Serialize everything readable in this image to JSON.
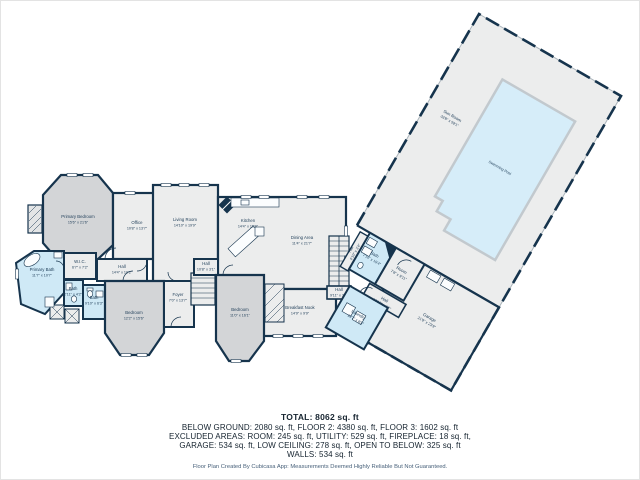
{
  "palette": {
    "wall": "#16344d",
    "room_fill": "#eceded",
    "bedroom_fill": "#d3d5d7",
    "wet_fill": "#cfe9f6",
    "pool_fill": "#d6edf9",
    "pool_border": "#c2c9ce",
    "label_color": "#1c3b56"
  },
  "rooms": [
    {
      "name": "Primary Bedroom",
      "dims": "15'6\" x 21'6\""
    },
    {
      "name": "Office",
      "dims": "10'8\" x 13'7\""
    },
    {
      "name": "Living Room",
      "dims": "14'10\" x 19'9\""
    },
    {
      "name": "Kitchen",
      "dims": "14'4\" x 15'9\""
    },
    {
      "name": "Dining Area",
      "dims": "11'4\" x 21'7\""
    },
    {
      "name": "Breakfast Nook",
      "dims": "14'9\" x 9'9\""
    },
    {
      "name": "Primary Bath",
      "dims": "11'7\" x 10'7\""
    },
    {
      "name": "W.I.C.",
      "dims": "6'7\" x 7'2\""
    },
    {
      "name": "Bath",
      "dims": "2'11\" x 4'2\""
    },
    {
      "name": "Bath",
      "dims": "9'10\" x 6'3\""
    },
    {
      "name": "Hall",
      "dims": "14'4\" x 10'2\""
    },
    {
      "name": "Bedroom",
      "dims": "12'2\" x 15'6\""
    },
    {
      "name": "Foyer",
      "dims": "7'0\" x 13'7\""
    },
    {
      "name": "Hall",
      "dims": "10'8\" x 3'1\""
    },
    {
      "name": "Bedroom",
      "dims": "11'0\" x 16'1\""
    },
    {
      "name": "Hall",
      "dims": "9'11\" x 3'3\""
    },
    {
      "name": "Bath",
      "dims": "7'10\" x 10'4\""
    },
    {
      "name": "Room",
      "dims": "7'8\" x 9'11\""
    },
    {
      "name": "Hall",
      "dims": "10'10\" x 4'2\""
    },
    {
      "name": "Laundry",
      "dims": "10'7\" x 8'9\""
    },
    {
      "name": "Hall",
      "dims": "4'10\" x 3'4\""
    },
    {
      "name": "Garage",
      "dims": "21'9\" x 23'9\""
    },
    {
      "name": "Sun Room",
      "dims": "33'8\" x 59'1\""
    },
    {
      "name": "Swimming Pool",
      "dims": ""
    }
  ],
  "summary": {
    "total": "TOTAL: 8062 sq. ft",
    "line2": "BELOW GROUND: 2080 sq. ft, FLOOR 2: 4380 sq. ft, FLOOR 3: 1602 sq. ft",
    "line3": "EXCLUDED AREAS: ROOM: 245 sq. ft, UTILITY: 529 sq. ft, FIREPLACE: 18 sq. ft,",
    "line4": "GARAGE: 534 sq. ft, LOW CEILING: 278 sq. ft, OPEN TO BELOW: 325 sq. ft",
    "line5": "WALLS: 534 sq. ft",
    "disclaimer": "Floor Plan Created By Cubicasa App: Measurements Deemed Highly Reliable But Not Guaranteed."
  }
}
